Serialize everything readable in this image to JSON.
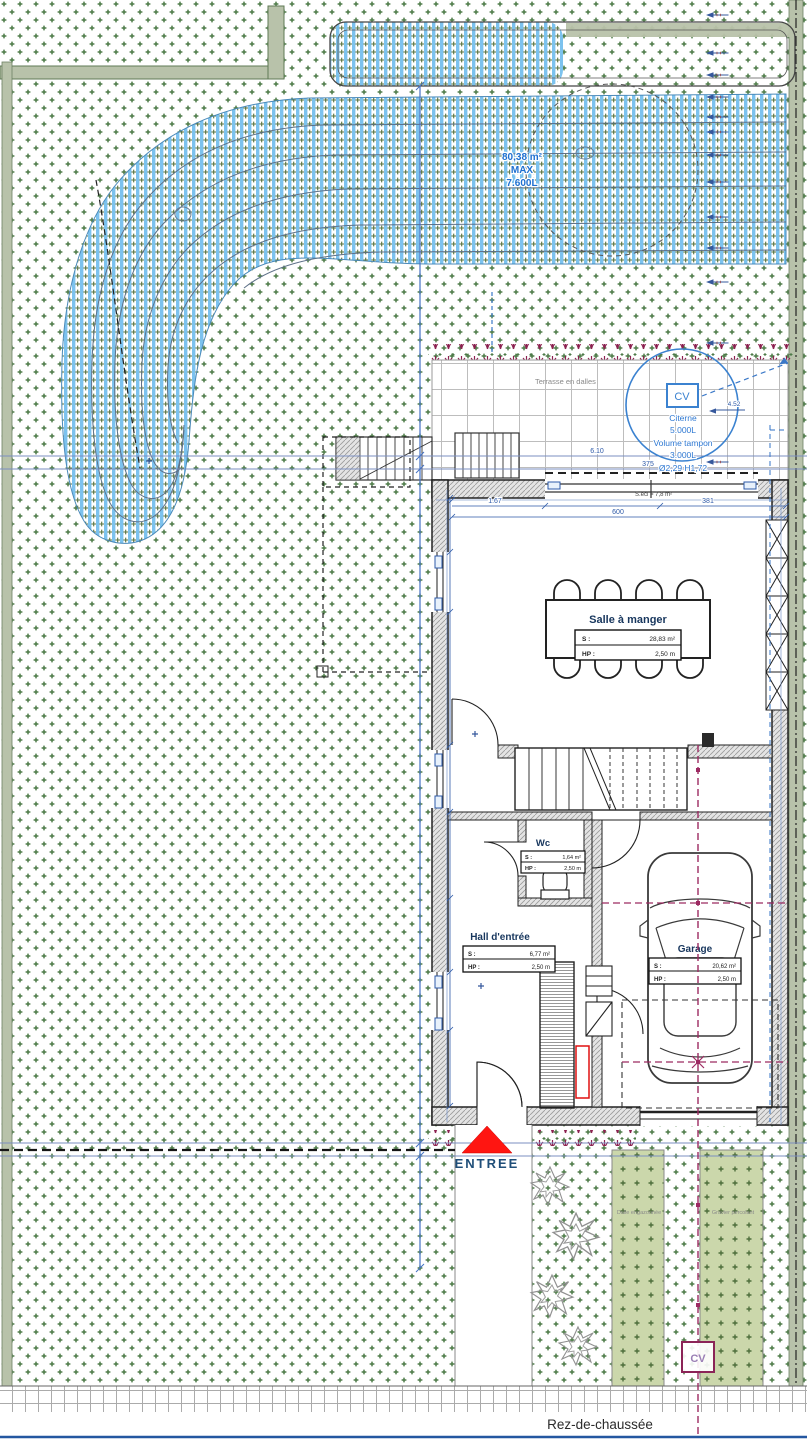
{
  "sheet": {
    "title": "Rez-de-chaussée"
  },
  "site": {
    "entrance_label": "ENTREE",
    "terrace_label": "Terrasse en dalles",
    "window_note": "S.écl = 7,8 m²",
    "basin": {
      "lines": [
        "80,38 m²",
        "MAX",
        "7.600L"
      ]
    },
    "cistern": {
      "tag": "CV",
      "lines": [
        "Citerne",
        "5.000L",
        "Volume tampon",
        "3.000L",
        "Ø2,29 H1,72"
      ]
    },
    "cv_manhole": "CV",
    "strips": {
      "left": "Dalle engazonnée",
      "right": "Gravier percolant"
    },
    "dims": {
      "d1": "1.67",
      "d2": "381",
      "d3": "600",
      "d4": "375",
      "d5": "6.10",
      "d6": "4.52"
    }
  },
  "rooms": [
    {
      "name": "Salle à manger",
      "s_label": "S :",
      "s_value": "28,83 m²",
      "hp_label": "HP :",
      "hp_value": "2,50 m"
    },
    {
      "name": "Wc",
      "s_label": "S :",
      "s_value": "1,64 m²",
      "hp_label": "HP :",
      "hp_value": "2,50 m"
    },
    {
      "name": "Hall d'entrée",
      "s_label": "S :",
      "s_value": "6,77 m²",
      "hp_label": "HP :",
      "hp_value": "2,50 m"
    },
    {
      "name": "Garage",
      "s_label": "S :",
      "s_value": "20,62 m²",
      "hp_label": "HP :",
      "hp_value": "2,50 m"
    }
  ],
  "colors": {
    "accent_blue": "#2e6fce",
    "hatch_blue": "#7cc2ee",
    "pipe_magenta": "#9c2a62",
    "entrance_red": "#ff1511",
    "border_blue": "#2457a0",
    "dots_green": "#4d7b48"
  }
}
